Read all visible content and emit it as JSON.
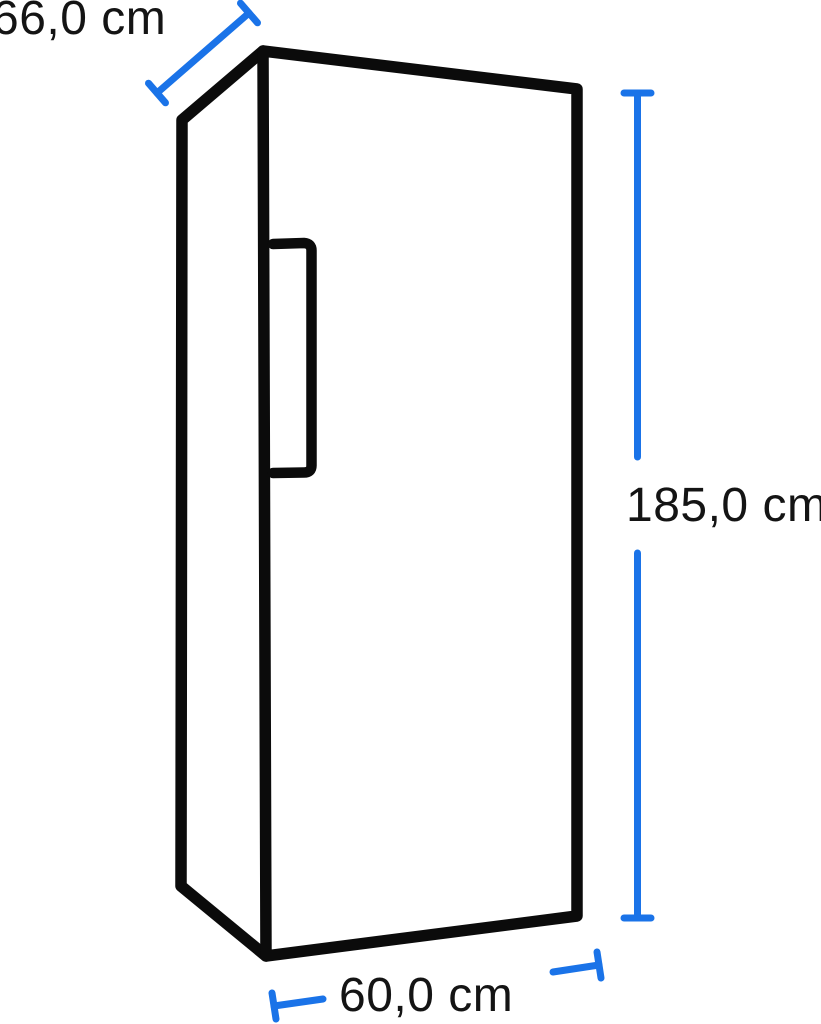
{
  "diagram": {
    "subject": "upright-refrigerator-outline",
    "dimensions": {
      "depth": {
        "label": "66,0 cm",
        "value_cm": 66.0,
        "placement": "diagonal-top-left"
      },
      "height": {
        "label": "185,0 cm",
        "value_cm": 185.0,
        "placement": "vertical-right"
      },
      "width": {
        "label": "60,0 cm",
        "value_cm": 60.0,
        "placement": "horizontal-bottom"
      }
    }
  },
  "colors": {
    "outline": "#0b0b0b",
    "dimension_line": "#1a73e8",
    "label_text": "#141414",
    "background": "#ffffff"
  }
}
